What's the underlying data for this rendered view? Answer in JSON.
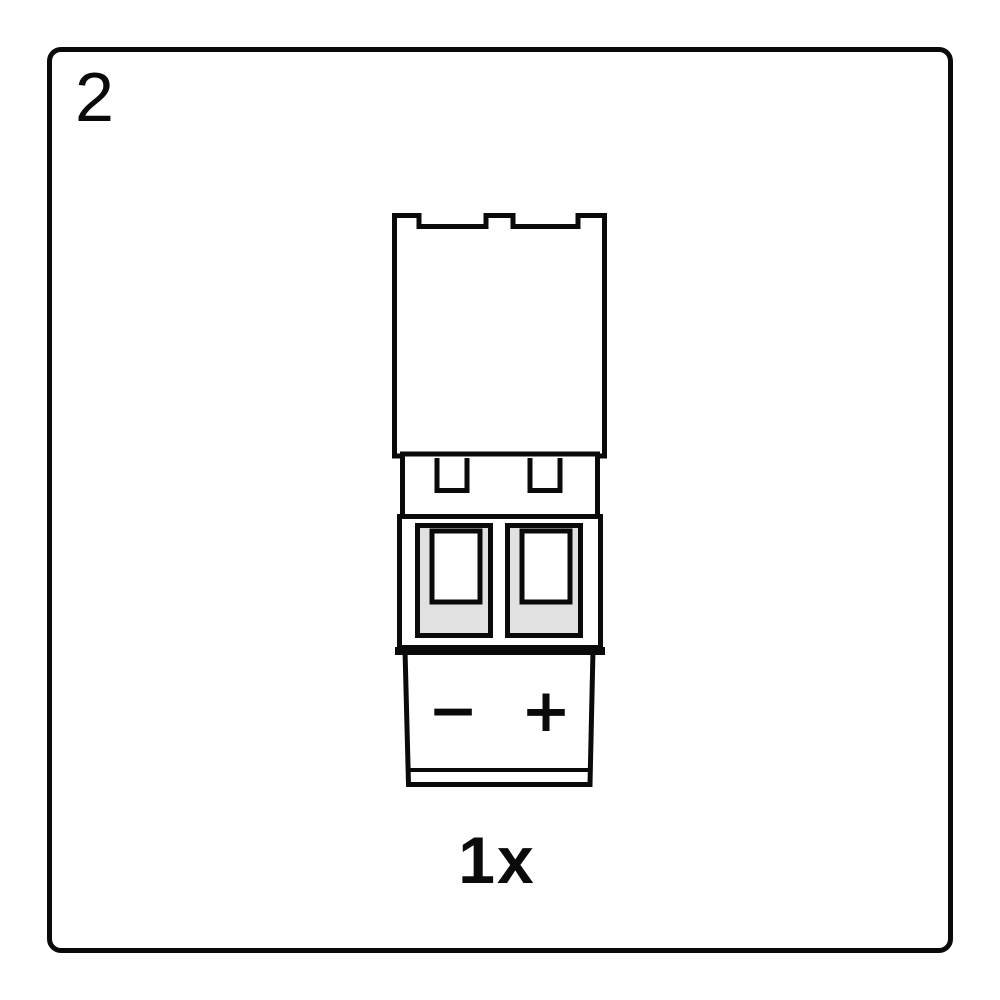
{
  "page": {
    "background_color": "#ffffff",
    "line_color": "#0a0a0a"
  },
  "step": {
    "number": "2"
  },
  "quantity": {
    "label": "1x"
  },
  "connector": {
    "icon": "two-pin-screw-terminal-plug",
    "cavity_fill_color": "#e1e1e1",
    "polarity": {
      "negative": "−",
      "positive": "+"
    }
  }
}
